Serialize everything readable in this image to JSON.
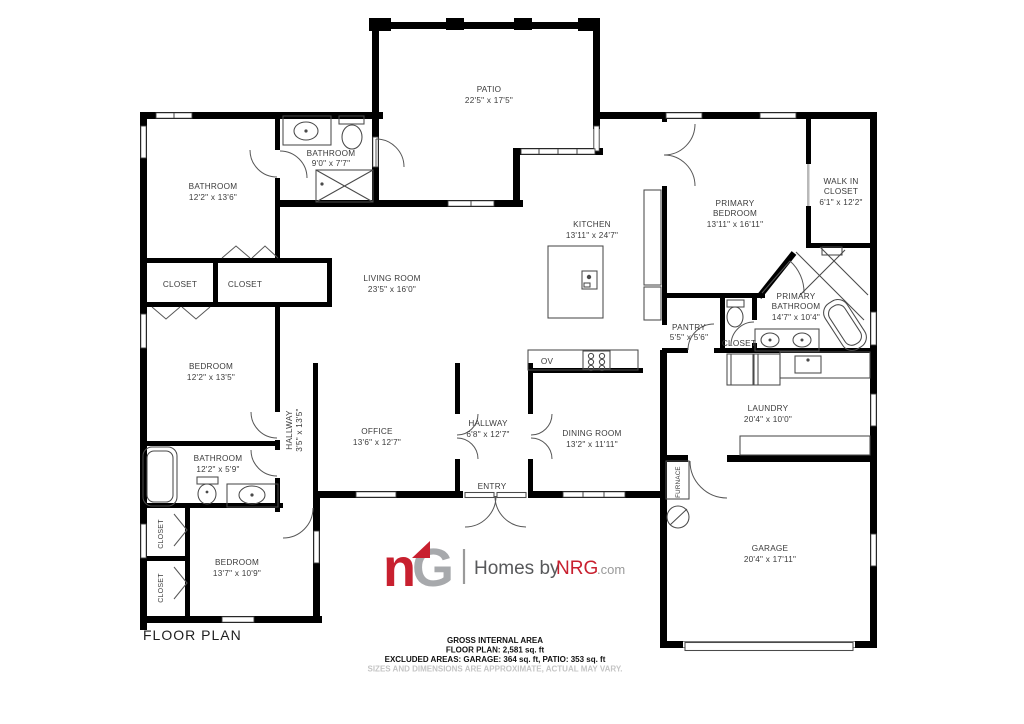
{
  "title": "FLOOR PLAN",
  "rooms": {
    "patio": {
      "name": "PATIO",
      "dims": "22'5\" x 17'5\""
    },
    "bathroom_small": {
      "name": "BATHROOM",
      "dims": "9'0\" x 7'7\""
    },
    "bathroom_left": {
      "name": "BATHROOM",
      "dims": "12'2\" x 13'6\""
    },
    "closet_a": {
      "name": "CLOSET"
    },
    "closet_b": {
      "name": "CLOSET"
    },
    "bedroom_left": {
      "name": "BEDROOM",
      "dims": "12'2\" x 13'5\""
    },
    "living_room": {
      "name": "LIVING ROOM",
      "dims": "23'5\" x 16'0\""
    },
    "kitchen": {
      "name": "KITCHEN",
      "dims": "13'11\" x 24'7\""
    },
    "primary_bedroom": {
      "name1": "PRIMARY",
      "name2": "BEDROOM",
      "dims": "13'11\" x 16'11\""
    },
    "walk_in_closet": {
      "name1": "WALK IN",
      "name2": "CLOSET",
      "dims": "6'1\" x 12'2\""
    },
    "primary_bathroom": {
      "name1": "PRIMARY",
      "name2": "BATHROOM",
      "dims": "14'7\" x 10'4\""
    },
    "pantry": {
      "name": "PANTRY",
      "dims": "5'5\" x 5'6\""
    },
    "closet_wc": {
      "name": "CLOSET"
    },
    "laundry": {
      "name": "LAUNDRY",
      "dims": "20'4\" x 10'0\""
    },
    "hallway_small": {
      "name": "HALLWAY",
      "dims": "3'5\" x 13'5\""
    },
    "office": {
      "name": "OFFICE",
      "dims": "13'6\" x 12'7\""
    },
    "hallway_main": {
      "name": "HALLWAY",
      "dims": "6'8\" x 12'7\""
    },
    "dining_room": {
      "name": "DINING ROOM",
      "dims": "13'2\" x 11'11\""
    },
    "entry": {
      "name": "ENTRY"
    },
    "furnace": {
      "name": "FURNACE"
    },
    "garage": {
      "name": "GARAGE",
      "dims": "20'4\" x 17'11\""
    },
    "bathroom_bottom": {
      "name": "BATHROOM",
      "dims": "12'2\" x 5'9\""
    },
    "closet_bed3_a": {
      "name": "CLOSET"
    },
    "closet_bed3_b": {
      "name": "CLOSET"
    },
    "bedroom_bottom": {
      "name": "BEDROOM",
      "dims": "13'7\" x 10'9\""
    },
    "oven": {
      "name": "OV"
    }
  },
  "logo": {
    "mark_n": "n",
    "mark_g": "G",
    "homes_by": "Homes by",
    "nrg": "NRG",
    "com": ".com"
  },
  "footer": {
    "area_title": "GROSS INTERNAL AREA",
    "area_line1": "FLOOR PLAN: 2,581 sq. ft",
    "area_line2": "EXCLUDED AREAS: GARAGE: 364 sq. ft, PATIO: 353 sq. ft",
    "disclaimer": "SIZES AND DIMENSIONS ARE APPROXIMATE, ACTUAL MAY VARY."
  },
  "colors": {
    "wall": "#000000",
    "fixture": "#4a4a4a",
    "label": "#3b3b3b",
    "brand_red": "#c8202f",
    "brand_gray": "#a7a9ac",
    "text_dark": "#58595b",
    "disclaimer_gray": "#c4c4c4"
  }
}
